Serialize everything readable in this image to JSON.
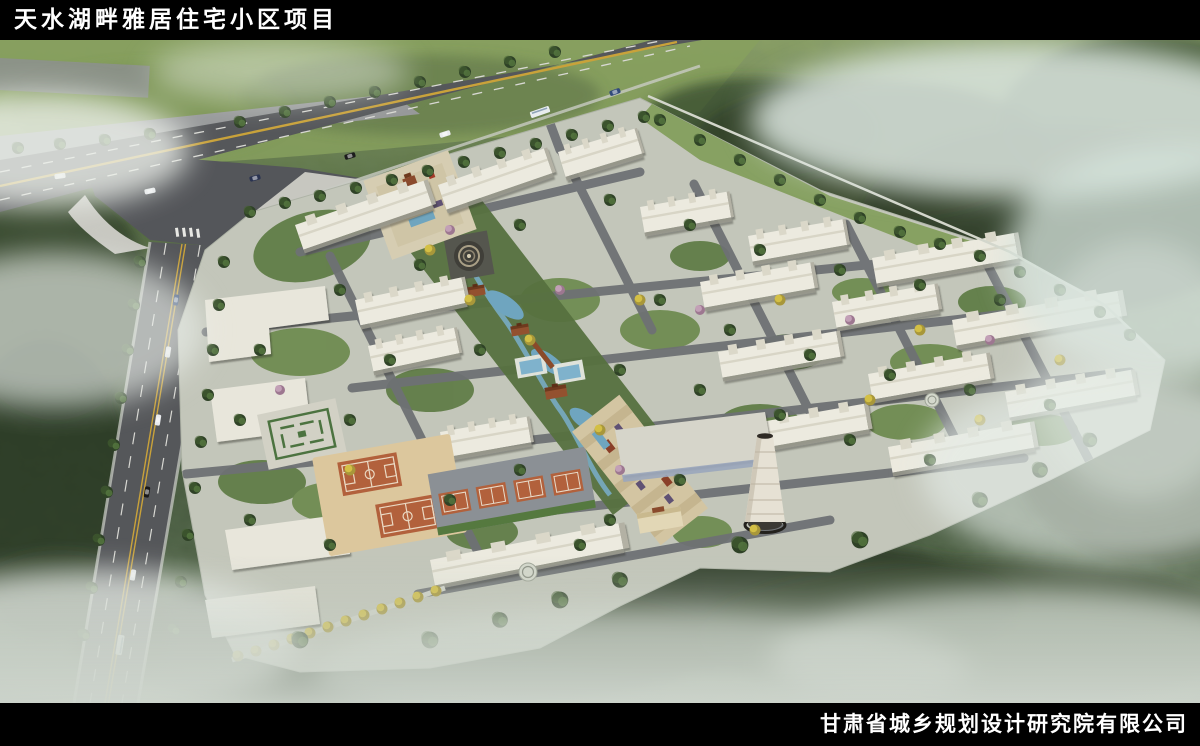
{
  "header": {
    "title": "天水湖畔雅居住宅小区项目"
  },
  "footer": {
    "company": "甘肃省城乡规划设计研究院有限公司"
  },
  "palette": {
    "band_background": "#000000",
    "band_text": "#ffffff",
    "forest_dark": "#3b4c31",
    "hills_light": "#87a05e",
    "road_asphalt": "#55575a",
    "road_centerline_yellow": "#c9a23a",
    "site_ground": "#c3c6ba",
    "building_roof": "#eceadf",
    "water": "#6fa5bf",
    "sport_court": "#b2613c",
    "fog": "#e9eeea",
    "accent_tree_yellow": "#d3bf45"
  }
}
